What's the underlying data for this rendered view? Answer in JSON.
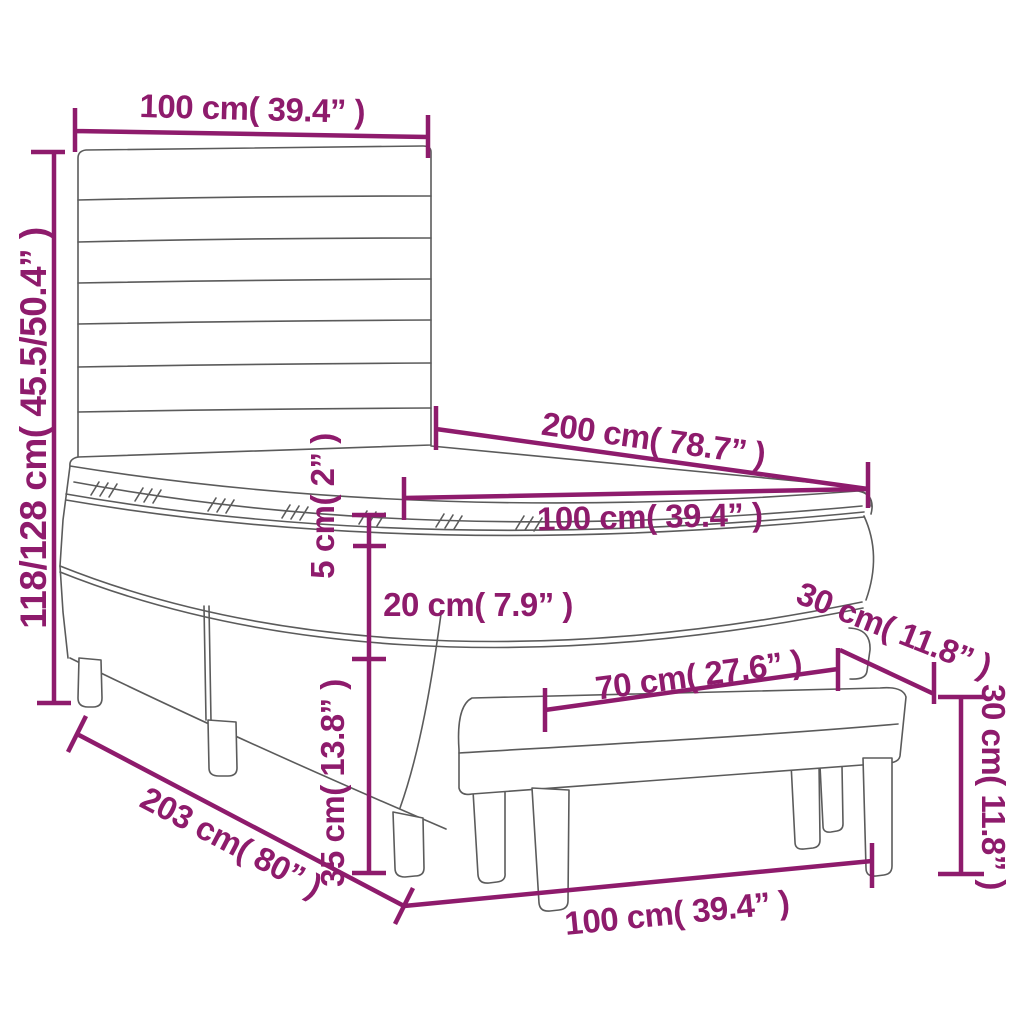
{
  "title": "Box spring bed with mattress, topper and bench — dimension diagram",
  "colors": {
    "dimension_accent": "#8e1b6c",
    "outline": "#5b5b5b",
    "background": "#ffffff"
  },
  "dimensions": {
    "headboard_width": {
      "label": "100 cm( 39.4” )",
      "measures": "headboard width, top"
    },
    "overall_height": {
      "label": "118/128 cm( 45.5/50.4” )",
      "measures": "bed height range, left side"
    },
    "bed_length": {
      "label": "200 cm( 78.7” )",
      "measures": "mattress length"
    },
    "mattress_width": {
      "label": "100 cm( 39.4” )",
      "measures": "mattress width"
    },
    "topper_thickness": {
      "label": "5 cm( 2” )",
      "measures": "topper thickness"
    },
    "mattress_thickness": {
      "label": "20 cm( 7.9” )",
      "measures": "mattress thickness"
    },
    "base_height": {
      "label": "35 cm( 13.8” )",
      "measures": "box spring base height"
    },
    "footprint_length": {
      "label": "203 cm( 80” )",
      "measures": "overall bed length"
    },
    "bench_seat_length": {
      "label": "70 cm( 27.6” )",
      "measures": "bench seat length"
    },
    "bench_depth": {
      "label": "30 cm( 11.8” )",
      "measures": "bench depth"
    },
    "bench_height": {
      "label": "30 cm( 11.8” )",
      "measures": "bench height"
    },
    "bench_length": {
      "label": "100 cm( 39.4” )",
      "measures": "bench overall length"
    }
  }
}
